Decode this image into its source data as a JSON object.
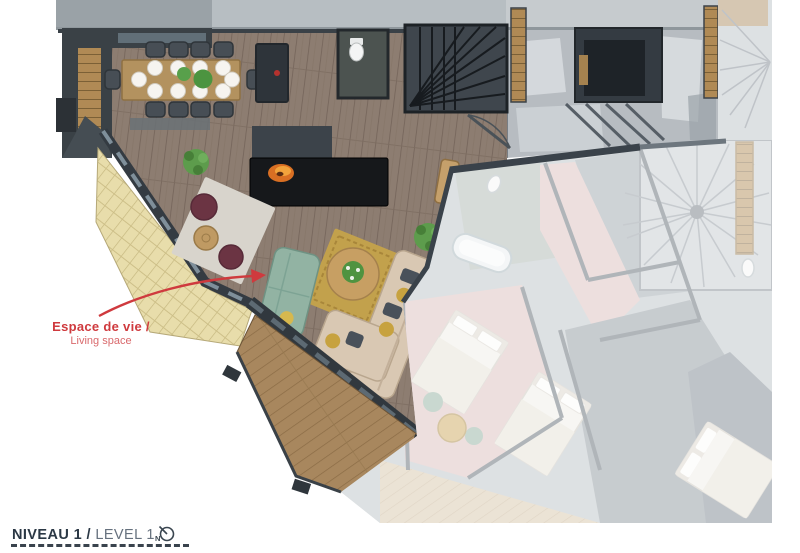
{
  "annotation": {
    "label_fr": "Espace de vie /",
    "label_en": "Living space"
  },
  "footer": {
    "level_fr": "NIVEAU 1 /",
    "level_en": "LEVEL 1",
    "compass_letter": "N"
  },
  "palette": {
    "annotation_red": "#cf3a3e",
    "title_dark": "#2b3845",
    "title_light": "#66717e",
    "floor_wood": "#8d7d71",
    "deck_wood": "#a8875e",
    "roof_shingle": "#e8ddab",
    "concrete": "#b7bcc1",
    "wall_dark": "#343b42",
    "sofa_green": "#92b3a3",
    "sofa_beige": "#d9c8b3",
    "rug_gold": "#c2a14c",
    "rug_gray": "#d8d4cc",
    "pouf_burgundy": "#6b3443",
    "bedroom_pink": "#d9bcba",
    "fire_orange": "#e08030"
  }
}
